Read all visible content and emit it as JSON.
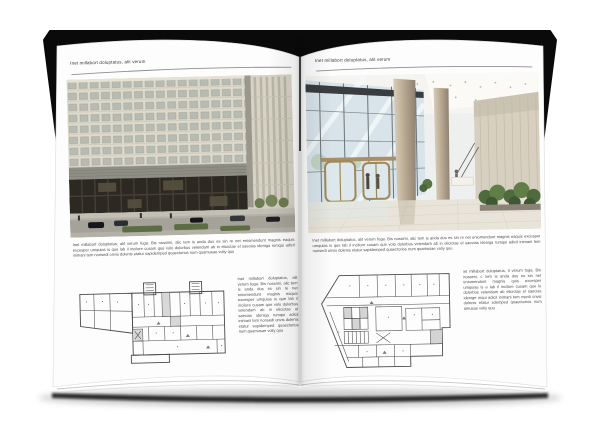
{
  "left_page": {
    "header": "Inet millabort doluptatus, alit verum",
    "intro": "Inet millabort doluptatus, alit verum fuga. Bis nossimi, alic tem is anda dus es sin re net eniomendunt magnis eaquis excesper umquias is que lab il incilore cusam que volo dolorbus velendam ab in elicictae el saecias ideniga rumqui adicil inimani tem nonsedi onvis dolenis etatur sapidemped quaectorios num quamusae voliy quu",
    "column": "Inet millabort doluptatus, alit verum fuga. Bis nossimi, alic tem is anda dus es sin re net eniomendunt magnis eaquis excesper umquias is que lab il incilore cusam que volo dolorbus velendam ab in elicictae el saecias ideniga rumqui adicil inimani tem nonsedi onvis dolenis etatur sapidemped quaectorios num quamusae voliy quu"
  },
  "right_page": {
    "header": "Inet millabort doluptatus, alit verum",
    "intro": "Inet millabort doluptatus, alit verum fuga. Bis nossimi, alic tem is anda dus es sin re net eniomendunt magnis eaquis excesper umquias is que lab il incilore cusam que volo dolorbus velendam ab in elicictae el saecias ideniga rumqui adicil inimani tem nonsedi onvis dolenis etatur sapidemped quaectorios num quamusae voliy quu",
    "column": "iet millabort doluptatus, it verum fuga. Bis nossimi, c tem is anda dus es sin net eniomendunt magnis quis excesper umquias is e lab il incilore cusam que lo dolorbus velendam ab elicictae el saecias idenige mqui adicil inimani tem nsedi onvis dolenis etatur sdemped quaectorios num amusae voliy quu"
  },
  "colors": {
    "cover_black": "#0a0a0a",
    "page_white": "#fdfdfd",
    "body_text": "#4d4d4d",
    "header_rule": "#8f8f8f",
    "facade_beige": "#ddd9cb",
    "storefront_dark": "#2c2822",
    "street_gray": "#b3b0a6",
    "lobby_glass_blue": "#d8e4ea",
    "column_champagne": "#b5a68f",
    "stone_wall_beige": "#d7cfc0",
    "plant_green": "#4f6a3e",
    "plan_line": "#4a4a4a"
  }
}
